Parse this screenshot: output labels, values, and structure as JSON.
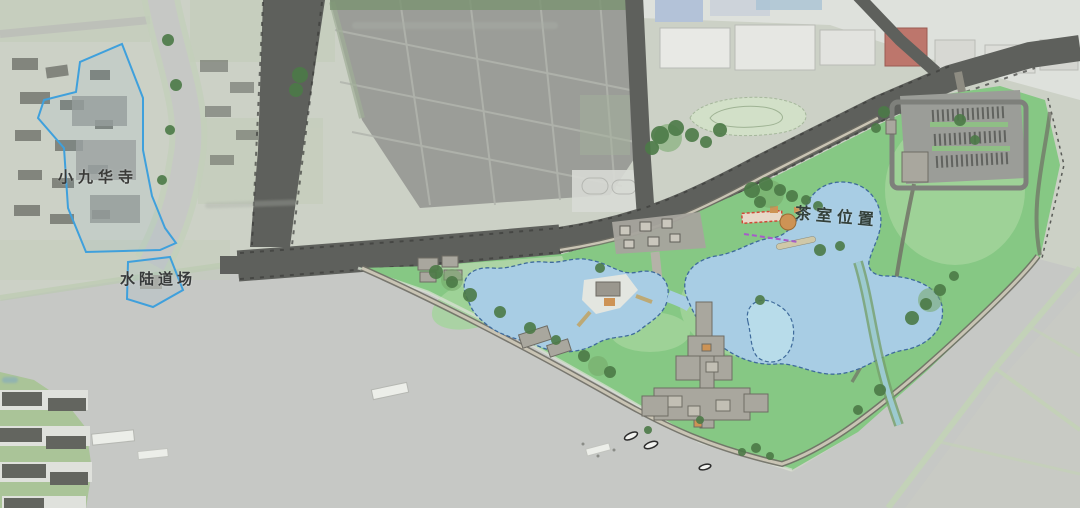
{
  "page": {
    "type": "landscape master-plan site map over aerial photo",
    "canvas": "1080x508"
  },
  "labels": {
    "temple": "小九华寺",
    "ritual_ground": "水陆道场",
    "tea_room": "茶室位置"
  },
  "colors": {
    "river": "#c6c8c5",
    "land": "#ccd1c6",
    "fields": "#c4cdba",
    "ponds": "#9b9d98",
    "pond_line": "#b2b5ae",
    "factory": "#e0e2dd",
    "red_roof": "#bd766c",
    "blue_roof": "#b3c2d8",
    "road": "#5e605c",
    "road_dash": "#3c3d3b",
    "park": "#86c884",
    "park_light": "#a4d59c",
    "lake": "#a8cde4",
    "lake_line": "#3f6b9b",
    "pond_small": "#b8dcea",
    "path_dark": "#6f6e65",
    "path_light": "#c9c4b4",
    "plaza": "#a6a49d",
    "building_gray": "#a9a79e",
    "building_orange": "#cd9355",
    "tree": "#4c7a47",
    "tree_light": "#74a868",
    "boundary_blue": "#3fa0dc",
    "red_dash": "#d14a38",
    "purple_dash": "#a65cc8",
    "village_roof": "#63655f",
    "shore_green": "#a6c392",
    "field_line": "#c2d4b4",
    "stream": "#9ccad0",
    "boat_white": "#eceee9"
  }
}
